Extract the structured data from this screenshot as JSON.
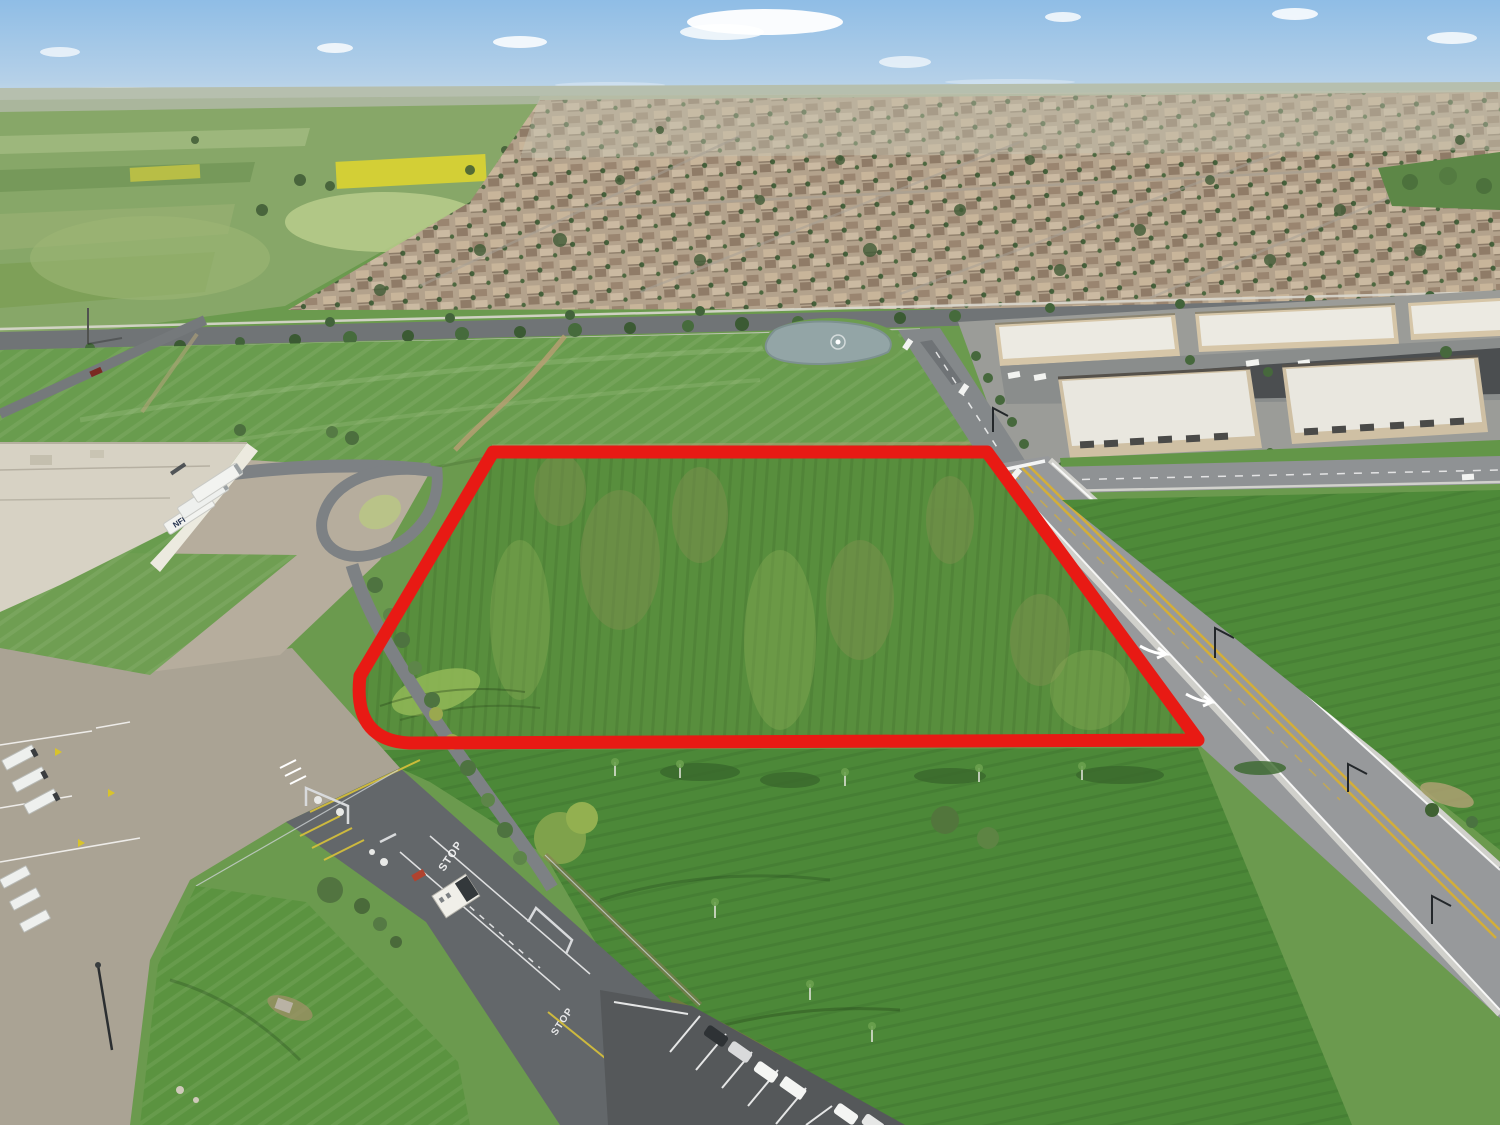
{
  "scene": {
    "type": "aerial-drone-photo",
    "subject": "vacant land parcel outlined in red beside warehouse, roads and residential neighborhood",
    "labels": {
      "trailer_brand": "NFI",
      "pavement_stop_north": "STOP",
      "pavement_stop_south": "STOP"
    },
    "colors": {
      "boundary_red": "#e81a14",
      "sky_top": "#8fbde6",
      "sky_horizon": "#d9e4ee",
      "parcel_green": "#588e3d",
      "field_green": "#4c8838",
      "road_gray": "#97999b",
      "concrete_yard": "#aaa394",
      "warehouse_roof": "#d7d2c4",
      "residential_tan": "#b3a28c",
      "pond_water": "#93a5a6"
    }
  }
}
